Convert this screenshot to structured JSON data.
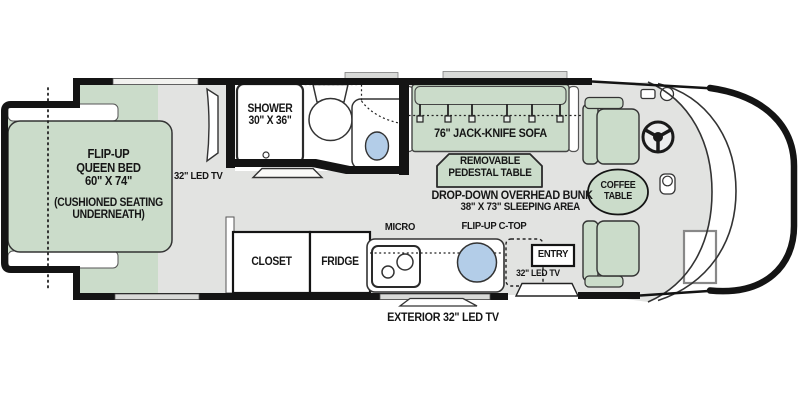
{
  "floorplan": {
    "type": "rv-motorhome-floor-plan",
    "bedroom": {
      "bed_line1": "FLIP-UP",
      "bed_line2": "QUEEN BED",
      "bed_line3": "60\" X 74\"",
      "note_line1": "(CUSHIONED SEATING",
      "note_line2": "UNDERNEATH)",
      "tv_label": "32\" LED TV"
    },
    "bathroom": {
      "shower_line1": "SHOWER",
      "shower_line2": "30\" X 36\""
    },
    "living": {
      "sofa_label": "76\" JACK-KNIFE SOFA",
      "table_line1": "REMOVABLE",
      "table_line2": "PEDESTAL TABLE",
      "bunk_line1": "DROP-DOWN OVERHEAD BUNK",
      "bunk_line2": "38\" X 73\" SLEEPING AREA"
    },
    "kitchen": {
      "closet_label": "CLOSET",
      "fridge_label": "FRIDGE",
      "micro_label": "MICRO",
      "ctop_label": "FLIP-UP C-TOP"
    },
    "entry": {
      "entry_label": "ENTRY",
      "tv_label": "32\" LED TV",
      "exterior_tv_label": "EXTERIOR 32\" LED TV"
    },
    "cab": {
      "coffee_line1": "COFFEE",
      "coffee_line2": "TABLE"
    },
    "fixtures": [
      "flip-up-queen-bed",
      "wardrobe-cabinets",
      "bedroom-tv",
      "shower",
      "toilet",
      "vanity-sink",
      "jack-knife-sofa",
      "seat-belts",
      "pedestal-table",
      "closet",
      "fridge",
      "microwave",
      "cooktop",
      "kitchen-sink",
      "flip-up-countertop",
      "entry-door-steps",
      "exterior-tv",
      "passenger-seat",
      "driver-seat",
      "coffee-table",
      "steering-wheel",
      "step-well"
    ]
  },
  "colors": {
    "furniture_green": "#cbdcca",
    "floor_gray": "#e2e3e1",
    "window_gray": "#d9dad8",
    "water_blue": "#b3cde8",
    "wall_black": "#141414"
  }
}
